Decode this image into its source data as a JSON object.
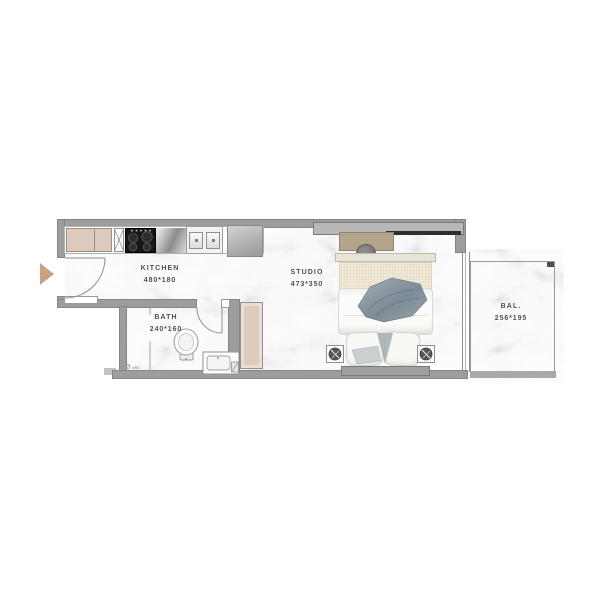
{
  "floorplan": {
    "rooms": {
      "kitchen": {
        "name": "KITCHEN",
        "dims": "480*180"
      },
      "studio": {
        "name": "STUDIO",
        "dims": "473*350"
      },
      "bath": {
        "name": "BATH",
        "dims": "240*160"
      },
      "balcony": {
        "name": "BAL.",
        "dims": "256*195"
      }
    },
    "annotations": {
      "bath_drain": "⌀60"
    },
    "colors": {
      "wall": "#9d9d9d",
      "floor_marble": "#f7f7f7",
      "kitchen_cabinet": "#dccbbc",
      "wardrobe": "#ddccbd",
      "entry_arrow": "#c9a183",
      "desk": "#b4a58a",
      "cooktop": "#181818",
      "closet": "#b8b8b8",
      "throw_blanket": "#8494a0",
      "balcony_rail": "#a9a9a9"
    }
  }
}
